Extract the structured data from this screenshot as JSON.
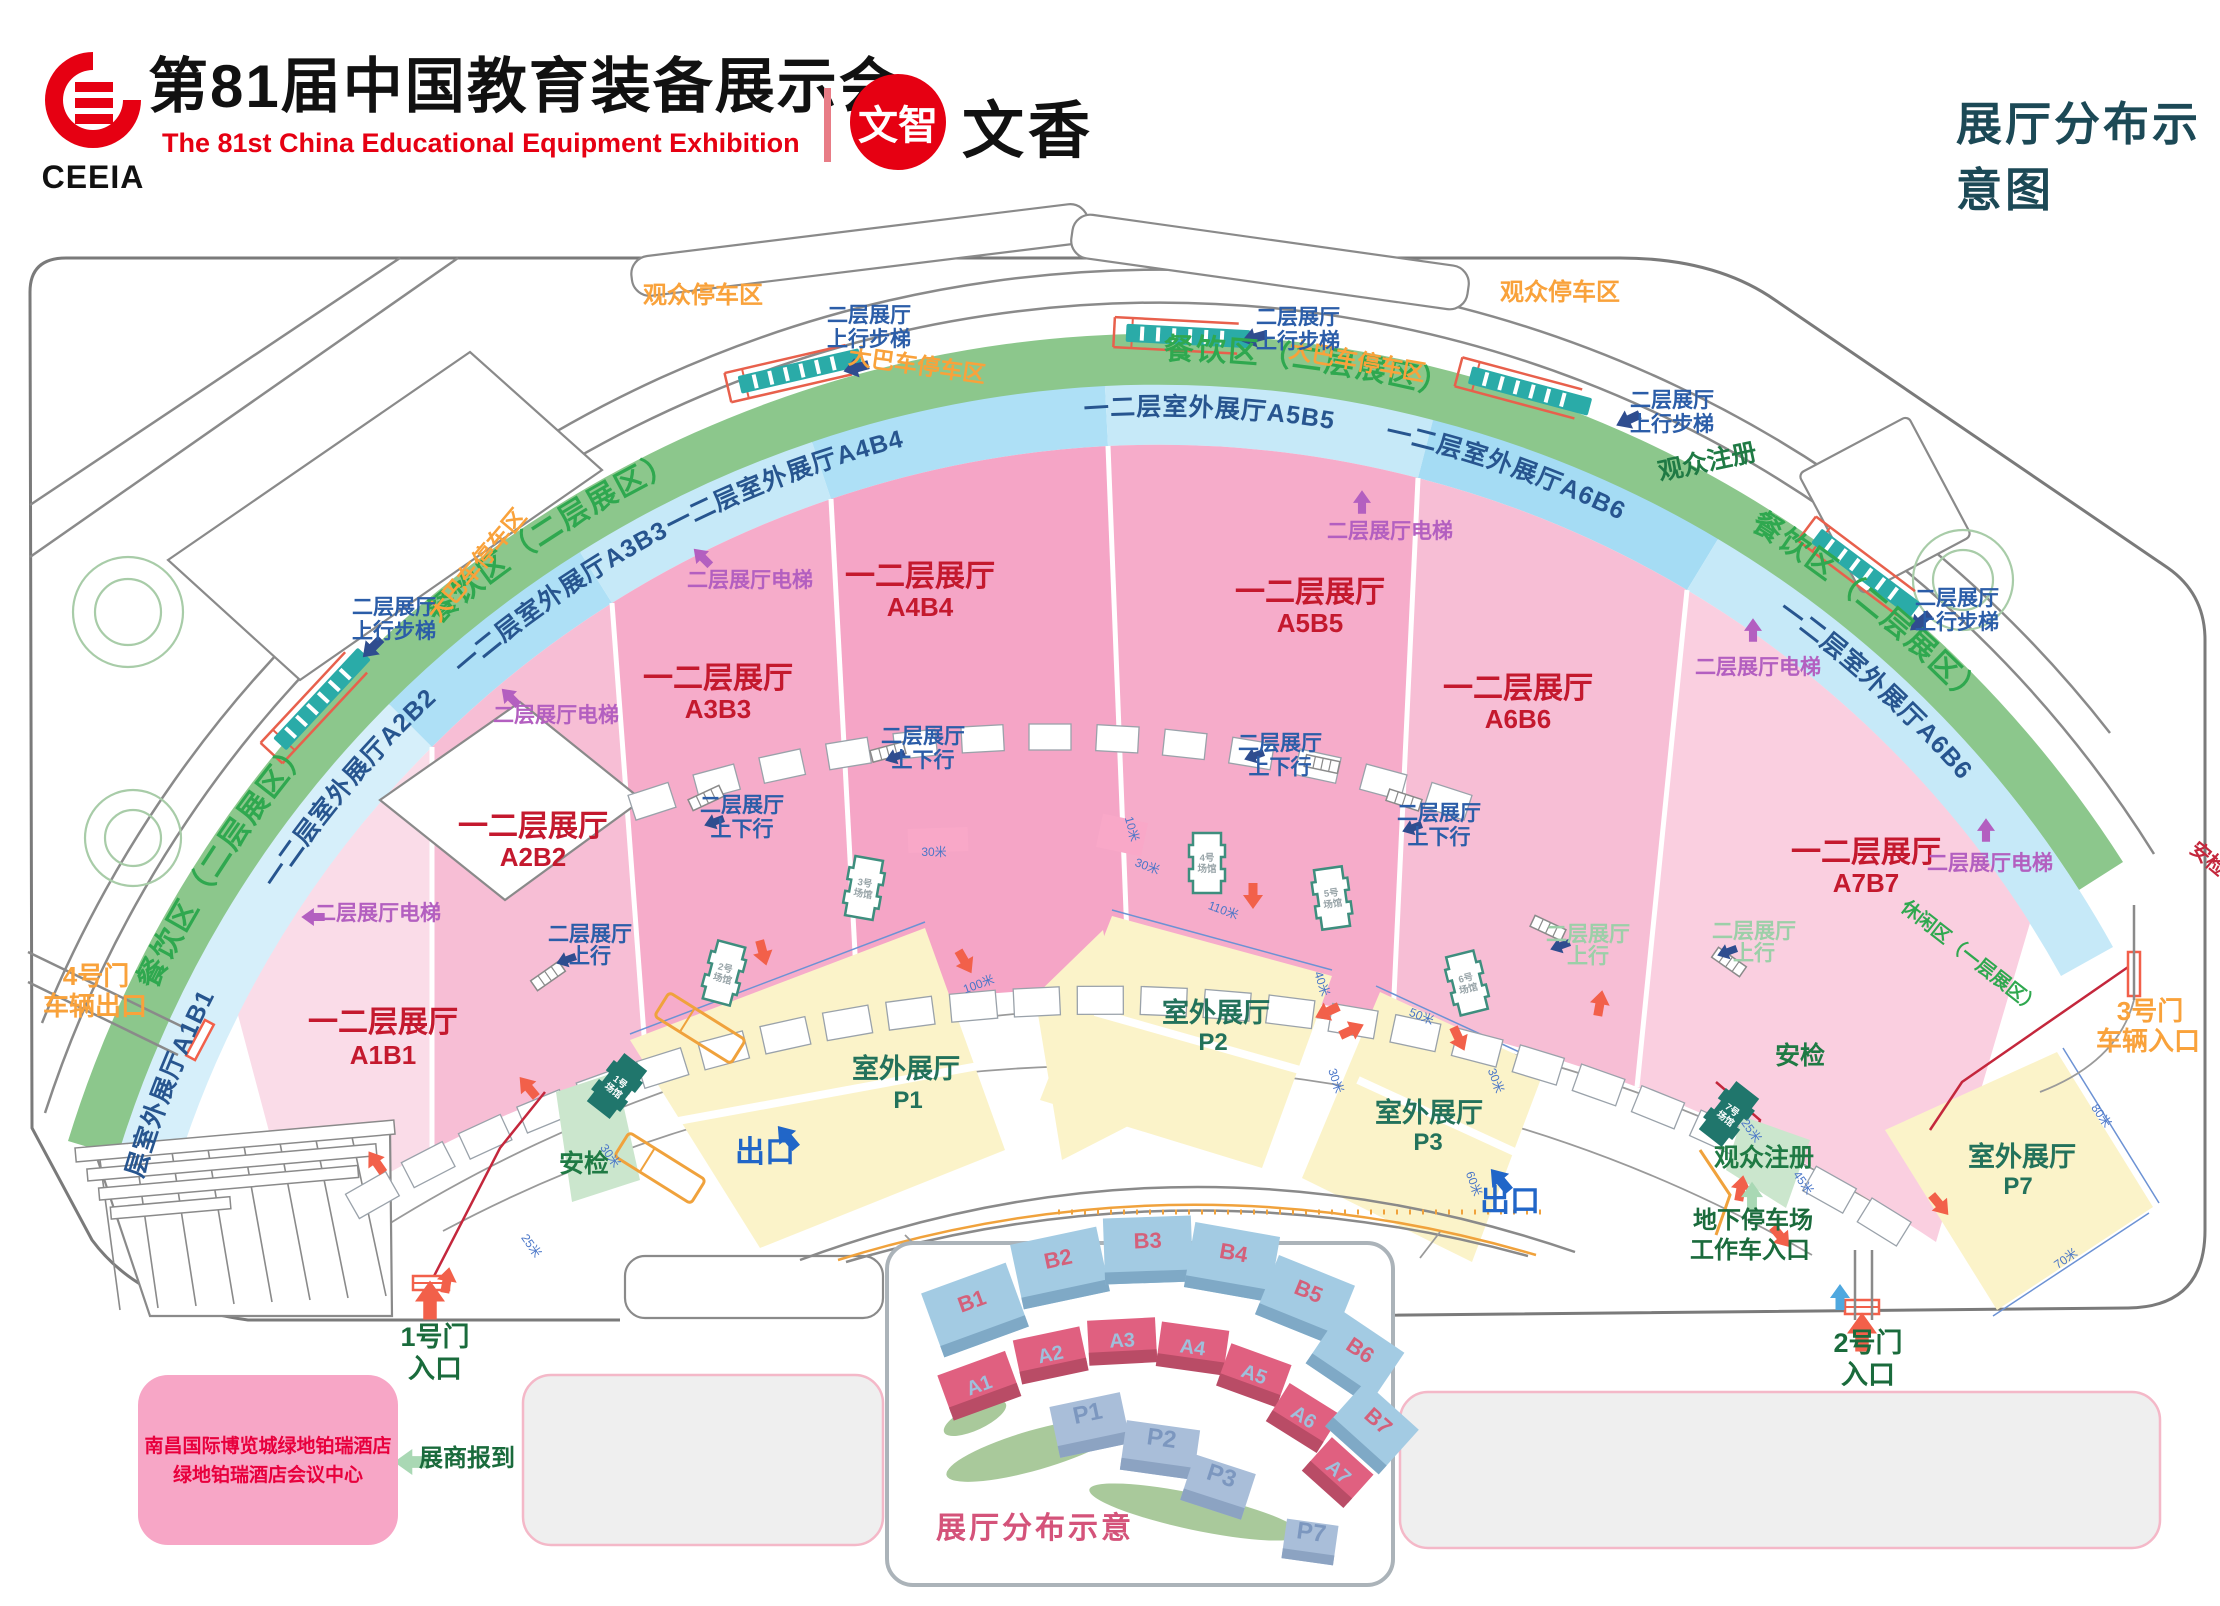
{
  "header": {
    "logo_acronym": "CEEIA",
    "title_cn": "第81届中国教育装备展示会",
    "title_en": "The 81st China Educational Equipment Exhibition",
    "partner_badge": "文智",
    "partner_name": "文香",
    "page_title": "展厅分布示意图"
  },
  "map": {
    "areas": {
      "visitor_parking": "观众停车区",
      "bus_parking": "大巴车停车区",
      "dining_full": "餐饮区（二层展区）",
      "leisure": "休闲区（一层展区）",
      "indoor_hall": "一二层展厅",
      "outdoor_hall": "室外展厅",
      "ring_halls": [
        "一二层室外展厅A1B1",
        "一二层室外展厅A2B2",
        "一二层室外展厅A3B3",
        "一二层室外展厅A4B4",
        "一二层室外展厅A5B5",
        "一二层室外展厅A6B6"
      ],
      "hall_codes": [
        "A1B1",
        "A2B2",
        "A3B3",
        "A4B4",
        "A5B5",
        "A6B6",
        "A7B7"
      ],
      "outdoor_codes": [
        "P1",
        "P2",
        "P3",
        "P7"
      ]
    },
    "facilities": {
      "stairs_l1": "二层展厅",
      "stairs_l2": "上行步梯",
      "updown_l1": "二层展厅",
      "updown_l2": "上下行",
      "up_l1": "二层展厅",
      "up_l2": "上行",
      "elevator": "二层展厅电梯",
      "registration": "观众注册",
      "security": "安检",
      "exit": "出口",
      "underground_l1": "地下停车场",
      "underground_l2": "工作车入口",
      "exhibitor_checkin": "展商报到"
    },
    "gates": {
      "g1_l1": "1号门",
      "g1_l2": "入口",
      "g2_l1": "2号门",
      "g2_l2": "入口",
      "g3_l1": "3号门",
      "g3_l2": "车辆入口",
      "g4_l1": "4号门",
      "g4_l2": "车辆出口"
    },
    "venues": [
      {
        "no": "1号",
        "type": "场馆"
      },
      {
        "no": "2号",
        "type": "场馆"
      },
      {
        "no": "3号",
        "type": "场馆"
      },
      {
        "no": "4号",
        "type": "场馆"
      },
      {
        "no": "5号",
        "type": "场馆"
      },
      {
        "no": "6号",
        "type": "场馆"
      },
      {
        "no": "7号",
        "type": "场馆"
      }
    ],
    "dimensions": {
      "d10": "10米",
      "d25": "25米",
      "d30": "30米",
      "d40": "40米",
      "d45": "45米",
      "d50": "50米",
      "d60": "60米",
      "d70": "70米",
      "d80": "80米",
      "d100": "100米",
      "d110": "110米"
    },
    "hotel_l1": "南昌国际博览城绿地铂瑞酒店",
    "hotel_l2": "绿地铂瑞酒店会议中心"
  },
  "inset": {
    "title": "展厅分布示意",
    "b": [
      "B1",
      "B2",
      "B3",
      "B4",
      "B5",
      "B6",
      "B7"
    ],
    "a": [
      "A1",
      "A2",
      "A3",
      "A4",
      "A5",
      "A6",
      "A7"
    ],
    "p": [
      "P1",
      "P2",
      "P3",
      "P7"
    ]
  },
  "colors": {
    "brand_red": "#E60012",
    "title_teal": "#1C4956",
    "dining_green": "#8CC78C",
    "ring_blue": "#AEE0F6",
    "hall_pink": "#F5A5C6",
    "outdoor_yellow": "#FBF3C9",
    "hall_label_red": "#C4192E",
    "gate_orange": "#F9A23B",
    "escalator_teal": "#2AABA8"
  }
}
